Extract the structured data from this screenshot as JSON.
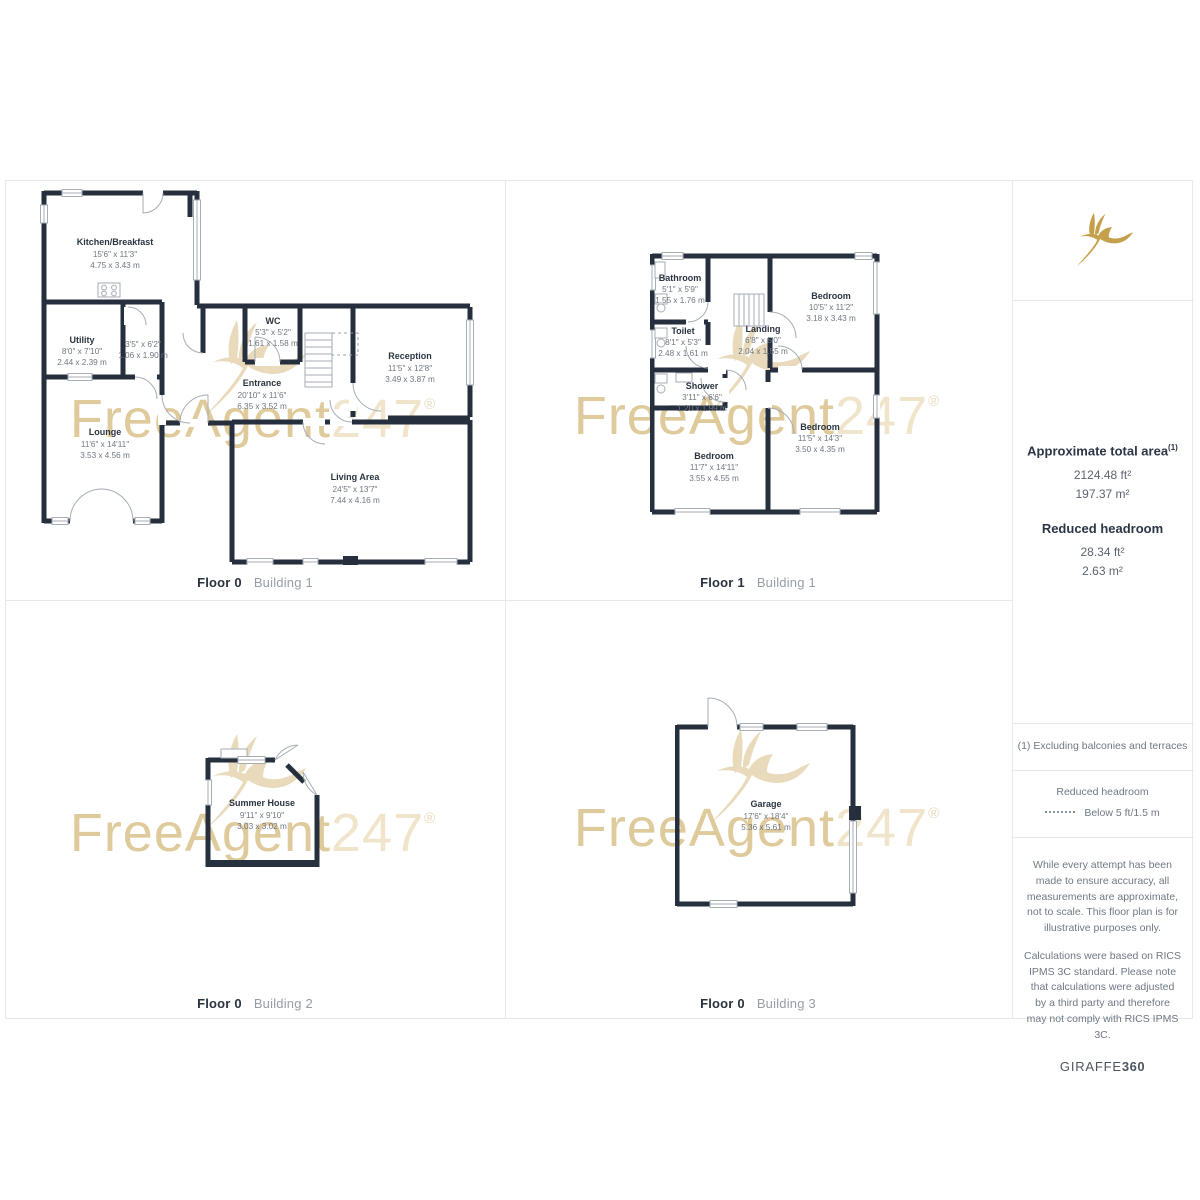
{
  "branding": {
    "watermark_text": "FreeAgent",
    "watermark_suffix": "247",
    "registered_symbol": "®",
    "gold_color": "#c5a04b",
    "footer_brand": "GIRAFFE",
    "footer_brand_bold": "360"
  },
  "colors": {
    "wall": "#252f3e",
    "border": "#e7e8ea",
    "room_name_text": "#2a3440",
    "dim_text": "#6e7780"
  },
  "plans": [
    {
      "id": "floor0-building1",
      "floor_label": "Floor 0",
      "building_label": "Building 1",
      "rooms": [
        {
          "name": "Kitchen/Breakfast",
          "imperial": "15'6\" x 11'3\"",
          "metric": "4.75 x 3.43 m"
        },
        {
          "name": "Utility",
          "imperial": "8'0\" x 7'10\"",
          "metric": "2.44 x 2.39 m"
        },
        {
          "name": "",
          "imperial": "3'5\" x 6'2\"",
          "metric": "1.06 x 1.90 m"
        },
        {
          "name": "WC",
          "imperial": "5'3\" x 5'2\"",
          "metric": "1.61 x 1.58 m"
        },
        {
          "name": "Entrance",
          "imperial": "20'10\" x 11'6\"",
          "metric": "6.35 x 3.52 m"
        },
        {
          "name": "Reception",
          "imperial": "11'5\" x 12'8\"",
          "metric": "3.49 x 3.87 m"
        },
        {
          "name": "Lounge",
          "imperial": "11'6\" x 14'11\"",
          "metric": "3.53 x 4.56 m"
        },
        {
          "name": "Living Area",
          "imperial": "24'5\" x 13'7\"",
          "metric": "7.44 x 4.16 m"
        }
      ]
    },
    {
      "id": "floor1-building1",
      "floor_label": "Floor 1",
      "building_label": "Building 1",
      "rooms": [
        {
          "name": "Bathroom",
          "imperial": "5'1\" x 5'9\"",
          "metric": "1.55 x 1.76 m"
        },
        {
          "name": "Toilet",
          "imperial": "8'1\" x 5'3\"",
          "metric": "2.48 x 1.61 m"
        },
        {
          "name": "Landing",
          "imperial": "6'8\" x 5'0\"",
          "metric": "2.04 x 1.55 m"
        },
        {
          "name": "Bedroom",
          "imperial": "10'5\" x 11'2\"",
          "metric": "3.18 x 3.43 m"
        },
        {
          "name": "Shower",
          "imperial": "3'11\" x 6'6\"",
          "metric": "1.20 x 1.99 m"
        },
        {
          "name": "Bedroom",
          "imperial": "11'5\" x 14'3\"",
          "metric": "3.50 x 4.35 m"
        },
        {
          "name": "Bedroom",
          "imperial": "11'7\" x 14'11\"",
          "metric": "3.55 x 4.55 m"
        }
      ]
    },
    {
      "id": "floor0-building2",
      "floor_label": "Floor 0",
      "building_label": "Building 2",
      "rooms": [
        {
          "name": "Summer House",
          "imperial": "9'11\" x 9'10\"",
          "metric": "3.03 x 3.02 m"
        }
      ]
    },
    {
      "id": "floor0-building3",
      "floor_label": "Floor 0",
      "building_label": "Building 3",
      "rooms": [
        {
          "name": "Garage",
          "imperial": "17'6\" x 18'4\"",
          "metric": "5.36 x 5.61 m"
        }
      ]
    }
  ],
  "summary_panel": {
    "total_area_heading": "Approximate total area",
    "total_area_footnote_ref": "(1)",
    "total_area_ft": "2124.48 ft²",
    "total_area_m": "197.37 m²",
    "reduced_headroom_heading": "Reduced headroom",
    "reduced_headroom_ft": "28.34 ft²",
    "reduced_headroom_m": "2.63 m²",
    "footnote": "(1) Excluding balconies and terraces",
    "legend_heading": "Reduced headroom",
    "legend_item": "Below 5 ft/1.5 m",
    "disclaimer_1": "While every attempt has been made to ensure accuracy, all measurements are approximate, not to scale. This floor plan is for illustrative purposes only.",
    "disclaimer_2": "Calculations were based on RICS IPMS 3C standard. Please note that calculations were adjusted by a third party and therefore may not comply with RICS IPMS 3C."
  }
}
